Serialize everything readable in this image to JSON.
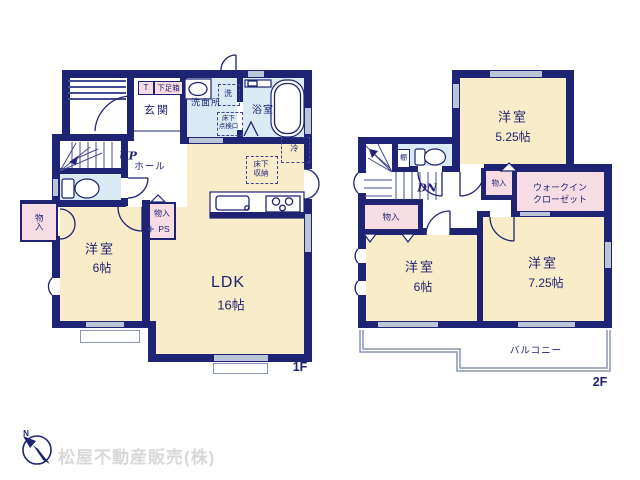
{
  "image": {
    "type": "floor-plan",
    "floors": [
      "1F",
      "2F"
    ]
  },
  "floor1": {
    "floor_label": "1F",
    "entrance": {
      "genkan": "玄関",
      "t_box": "T",
      "shoebox": "下足箱"
    },
    "washroom": {
      "name": "洗面所",
      "washer": "洗",
      "hatch_line1": "床下",
      "hatch_line2": "点検口"
    },
    "bathroom": {
      "name": "浴室"
    },
    "hall": {
      "name": "ホール",
      "stairs_label": "UP"
    },
    "closet_left": {
      "name": "物入"
    },
    "closet_ps": {
      "name": "物入",
      "ps_label": "PS",
      "ps_icon": "+"
    },
    "western_room": {
      "name": "洋室",
      "size": "6帖"
    },
    "ldk": {
      "name": "LDK",
      "size": "16帖",
      "fridge": "冷",
      "floor_storage_line1": "床下",
      "floor_storage_line2": "収納"
    }
  },
  "floor2": {
    "floor_label": "2F",
    "western_room_525": {
      "name": "洋室",
      "size": "5.25帖"
    },
    "toilet": {
      "shelf": "棚"
    },
    "hall": {
      "stairs_label": "DN"
    },
    "closet_left": {
      "name": "物入"
    },
    "closet_mid": {
      "name": "物入"
    },
    "wic": {
      "line1": "ウォークイン",
      "line2": "クローゼット"
    },
    "western_room_6": {
      "name": "洋室",
      "size": "6帖"
    },
    "western_room_725": {
      "name": "洋室",
      "size": "7.25帖"
    },
    "balcony": {
      "name": "バルコニー"
    }
  },
  "branding": {
    "compass_n": "N",
    "company": "松屋不動産販売(株)"
  },
  "colors": {
    "wall": "#1f2373",
    "room": "#f9ecc9",
    "closet": "#f8dce3",
    "wet": "#daebf6",
    "window": "#bcc5d8",
    "outline": "#8a94b5",
    "company_text": "#d8d8d8",
    "bg": "#ffffff"
  }
}
